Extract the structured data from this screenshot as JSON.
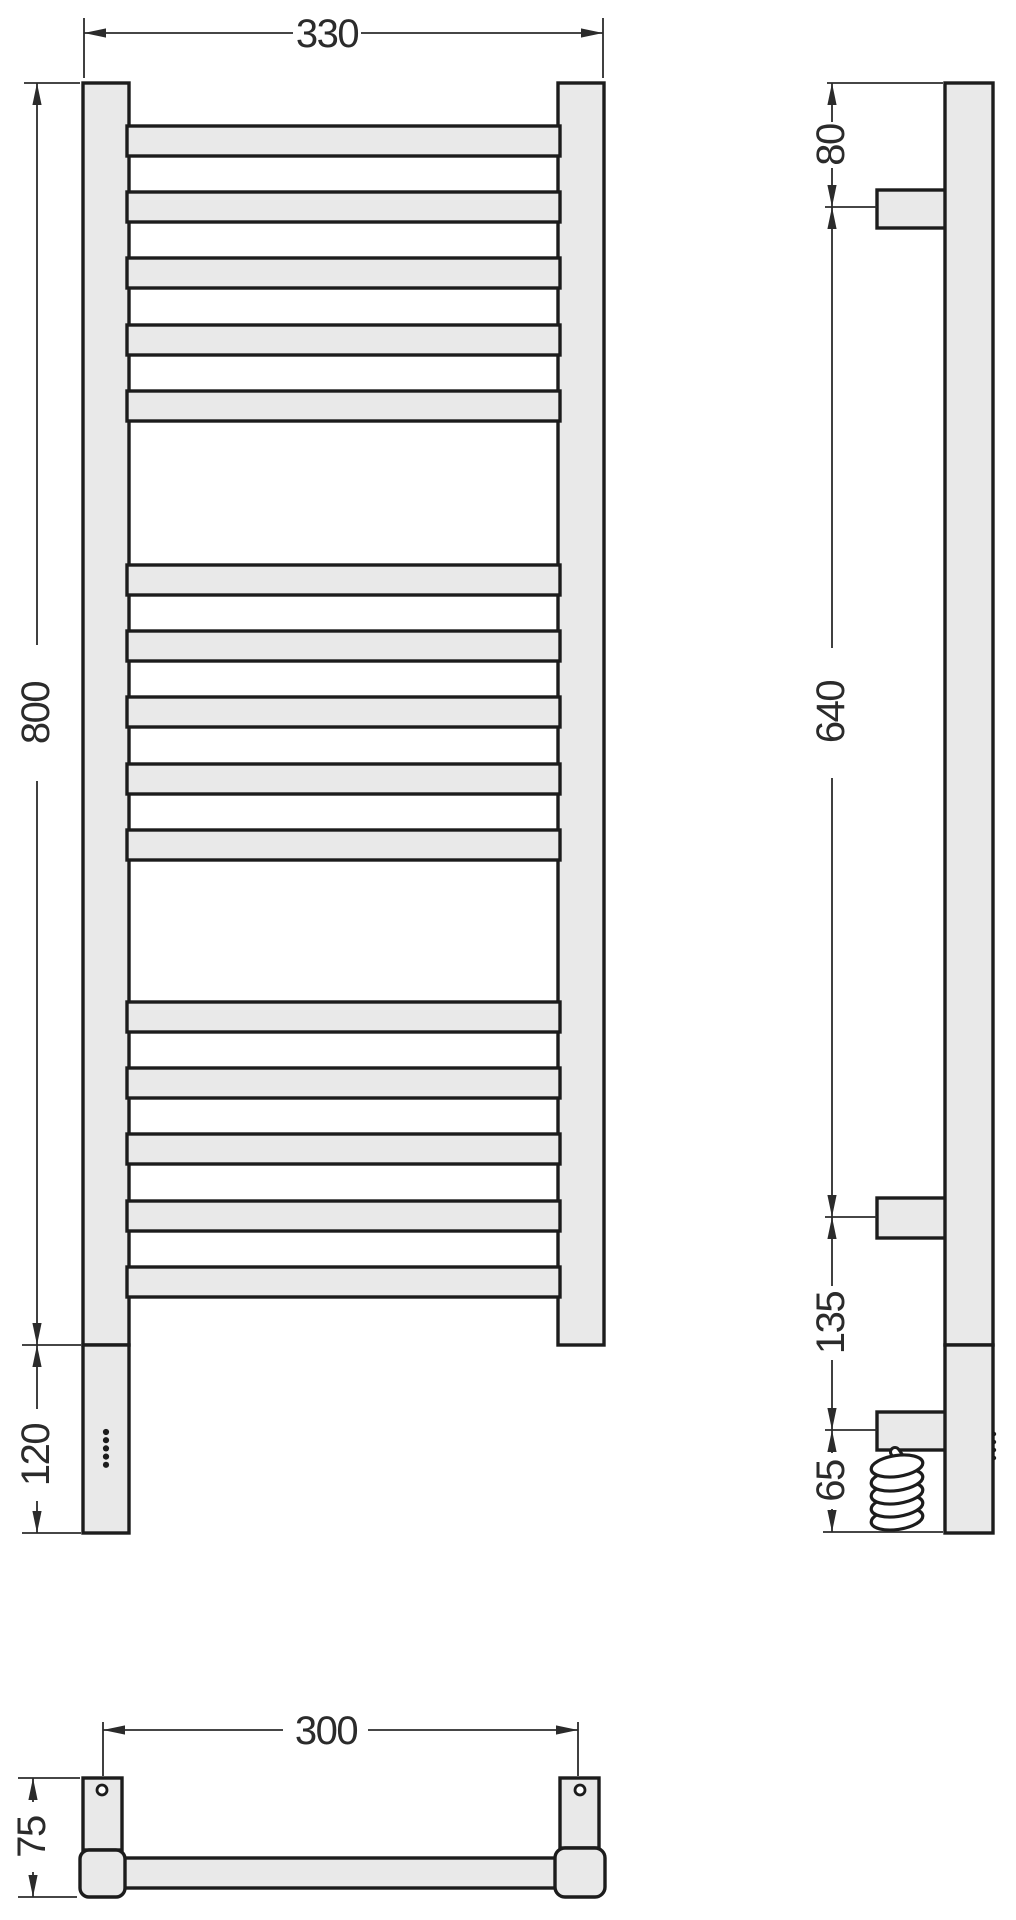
{
  "drawing": {
    "title": "towel-rail-technical-drawing",
    "views": {
      "front": {
        "label": "front-view"
      },
      "side": {
        "label": "side-view"
      },
      "bottom": {
        "label": "bottom-view"
      }
    },
    "ladder": {
      "rung_groups": 3,
      "rungs_per_group": 5,
      "total_rungs": 15,
      "indicator_dots": 5
    },
    "dimensions": {
      "front_width": {
        "value": "330"
      },
      "front_height": {
        "value": "800"
      },
      "front_lower_housing": {
        "value": "120"
      },
      "side_top_to_bracket": {
        "value": "80"
      },
      "side_bracket_span": {
        "value": "640"
      },
      "side_bracket_to_box": {
        "value": "135"
      },
      "side_box_to_bottom": {
        "value": "65"
      },
      "bottom_bracket_span": {
        "value": "300"
      },
      "bottom_depth": {
        "value": "75"
      }
    },
    "colors": {
      "line": "#1c1c1c",
      "fill": "#e9e9e9",
      "dim_line": "#2b2b2b",
      "background": "#ffffff"
    }
  }
}
